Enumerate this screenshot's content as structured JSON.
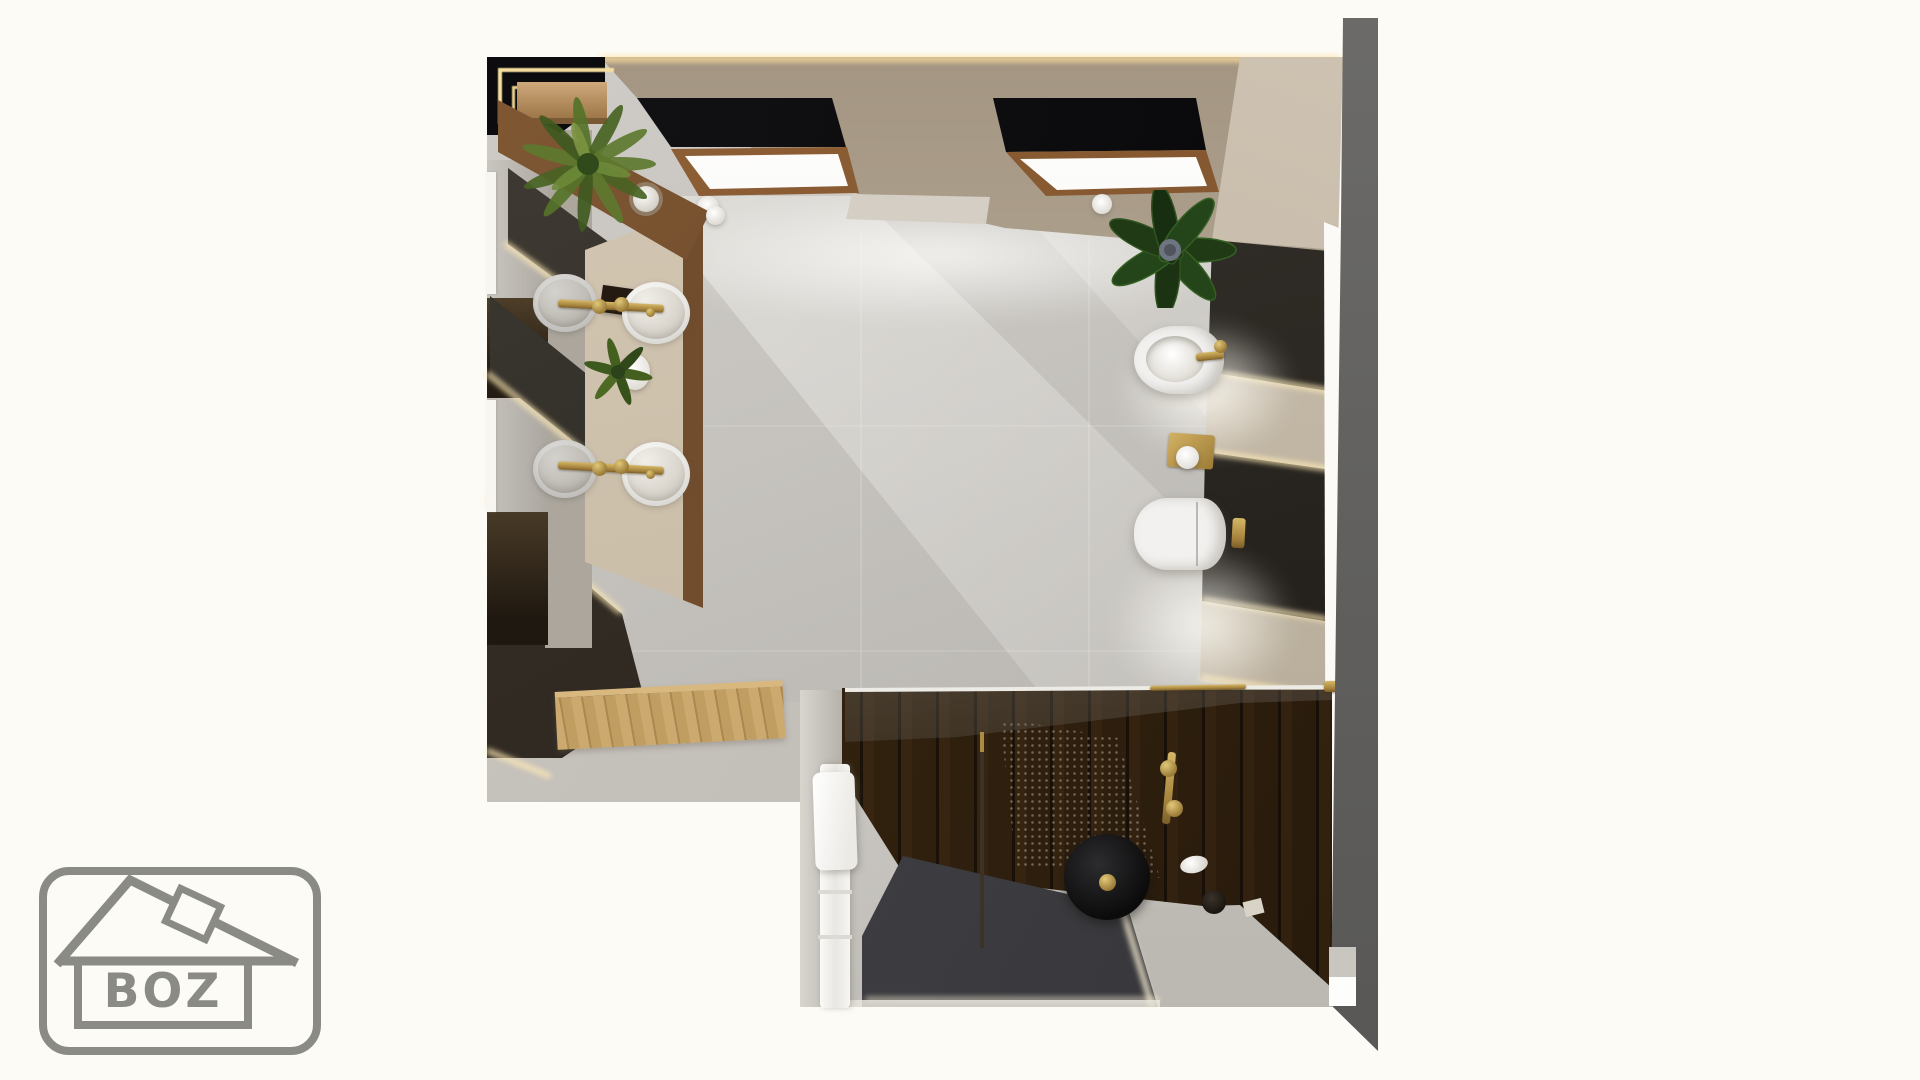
{
  "logo": {
    "text": "BOZ",
    "color": "#8b8b86",
    "shape": "rounded-rectangle-house-outline"
  },
  "palette": {
    "background": "#fcfbf5",
    "outer_wall_gray": "#636260",
    "wall_beige": "#b2a492",
    "wall_beige_light": "#c8bcab",
    "marble_floor": "#c7c4bf",
    "travertine": "#cfc3af",
    "slate_dark": "#332f2a",
    "walnut_wood": "#6d4a2c",
    "dark_plank_wood": "#2e1f14",
    "oak_light": "#c9a878",
    "brass_gold": "#b29249",
    "led_glow": "#ffe9bd",
    "fixture_white": "#f2f1ef",
    "plant_green": "#4e6b2a",
    "shower_floor_graphite": "#414145",
    "skylight_frame_wood": "#8a5a33",
    "logo_gray": "#8b8b86"
  },
  "scene": {
    "view": "top-down interior render",
    "fixtures": [
      "double-vanity-with-four-round-basins",
      "wall-mounted-brass-faucets",
      "bidet",
      "wall-hung-toilet",
      "brass-toilet-paper-holder",
      "brass-flush-plate",
      "walk-in-shower",
      "black-rain-shower-disc",
      "glass-shower-partition",
      "white-towel-ladder",
      "wooden-bath-mat",
      "two-skylights",
      "fern-plant",
      "accent-plant",
      "small-potted-plant"
    ],
    "materials": [
      "light-marble-floor",
      "travertine-counter",
      "dark-slate-panels",
      "walnut-wood",
      "led-strip-lighting"
    ]
  }
}
